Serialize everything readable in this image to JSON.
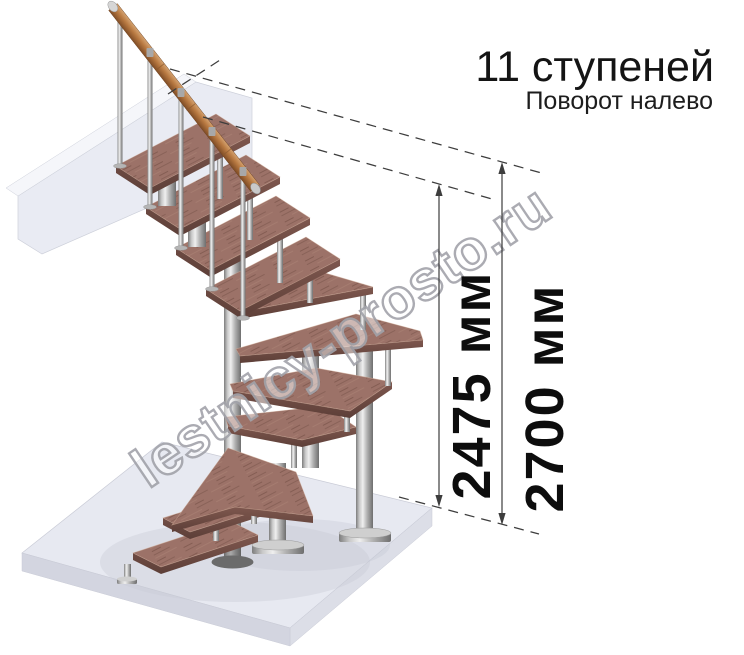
{
  "header": {
    "title": "11 ступеней",
    "subtitle": "Поворот налево"
  },
  "dimensions": {
    "inner_label": "2475 мм",
    "outer_label": "2700 мм"
  },
  "watermark": {
    "text": "lestnicy-prosto.ru"
  },
  "palette": {
    "tread_wood": "#9c7268",
    "tread_edge": "#6f4b43",
    "handrail_wood": "#b97a42",
    "metal": "#bfbfbf",
    "floor_slab": "#e7e9f1",
    "dimension_lines": "#3d3d3d",
    "text": "#141414"
  }
}
